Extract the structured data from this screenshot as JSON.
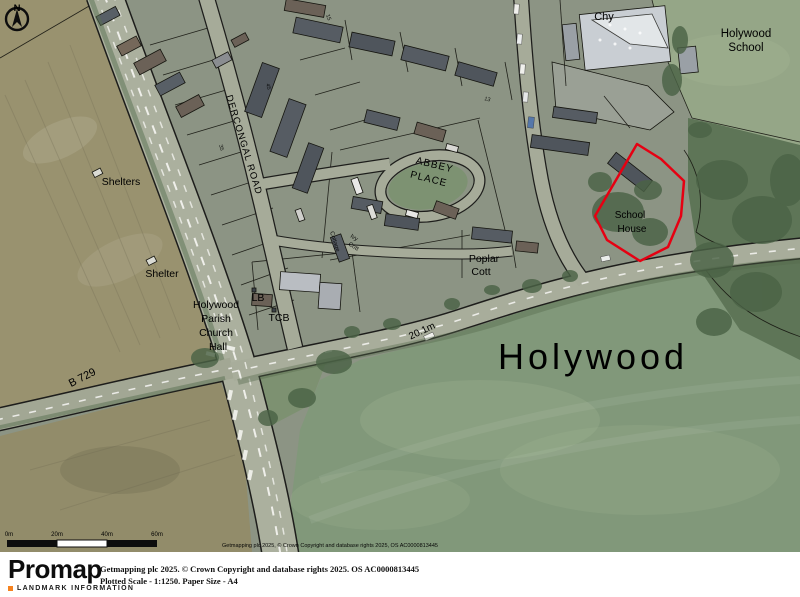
{
  "map": {
    "labels": {
      "chy": "Chy",
      "school_name": [
        "Holywood",
        "School"
      ],
      "shelters": "Shelters",
      "shelter": "Shelter",
      "church_hall": [
        "Holywood",
        "Parish",
        "Church",
        "Hall"
      ],
      "lb": "LB",
      "tcb": "TCB",
      "dercongal_road": "DERCONGAL ROAD",
      "abbey_place": [
        "ABBEY",
        "PLACE"
      ],
      "school_house": [
        "School",
        "House"
      ],
      "poplar_cott": [
        "Poplar",
        "Cott"
      ],
      "spot_height": "20.1m",
      "town": "Holywood",
      "b_road": "B 729",
      "ivy_cott": [
        "Ivy",
        "Cott"
      ],
      "cottage": "Cottage",
      "house_numbers": [
        "45",
        "35",
        "15",
        "13"
      ]
    },
    "compass_letter": "N",
    "scale_bar": {
      "ticks": [
        "0m",
        "20m",
        "40m",
        "60m"
      ]
    },
    "copyright_overlay": "Getmapping plc 2025, © Crown Copyright and database rights 2025, OS AC0000813445",
    "site_outline_color": "#e60012"
  },
  "footer": {
    "brand": "Promap",
    "brand_sub": "LANDMARK INFORMATION",
    "accent": "#f5821f",
    "line1": "Getmapping plc 2025. © Crown Copyright and database rights 2025. OS AC0000813445",
    "line2": "Plotted Scale - 1:1250. Paper Size - A4"
  }
}
